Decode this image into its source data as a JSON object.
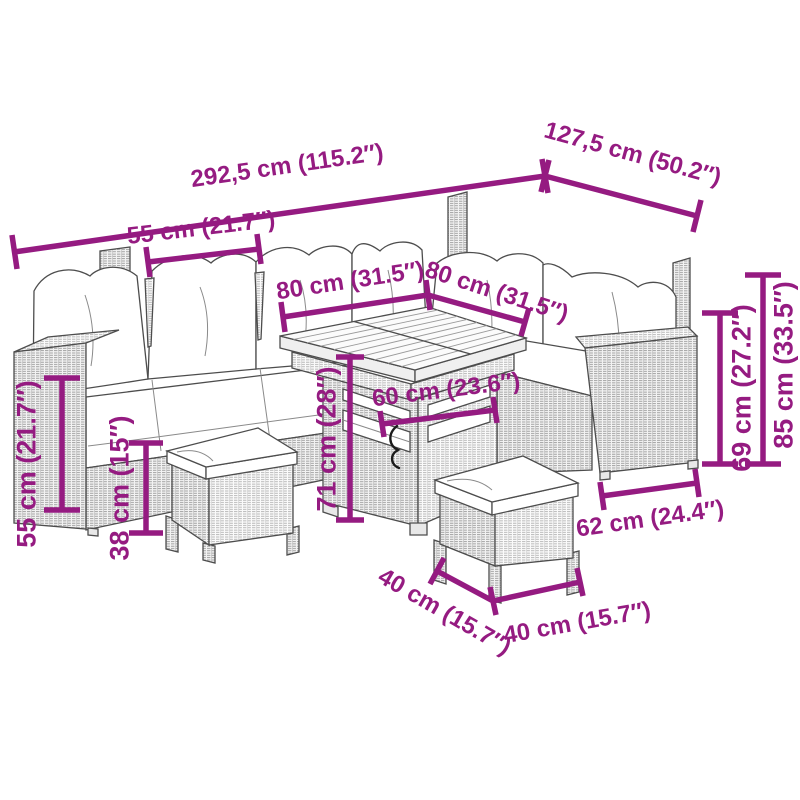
{
  "diagram": {
    "subject": "Poly rattan garden lounge set: corner sofa with cushions, cube table and two stools, dimension drawing",
    "accent_color": "#951B81",
    "outline_color": "#4D4D4D",
    "background_color": "#FFFFFF"
  },
  "labels": {
    "total_width": "292,5 cm (115.2″)",
    "total_depth": "127,5 cm (50.2″)",
    "seat_width": "55 cm (21.7″)",
    "table_width": "80 cm (31.5″)",
    "table_depth": "80 cm (31.5″)",
    "table_clearance_width": "60 cm (23.6″)",
    "table_height": "71 cm (28″)",
    "armrest_height": "55 cm (21.7″)",
    "seat_height": "38 cm (15″)",
    "backrest_height": "69 cm (27.2″)",
    "total_height": "85 cm (33.5″)",
    "armrest_depth": "62 cm (24.4″)",
    "stool_depth": "40 cm (15.7″)",
    "stool_width": "40 cm (15.7″)"
  }
}
